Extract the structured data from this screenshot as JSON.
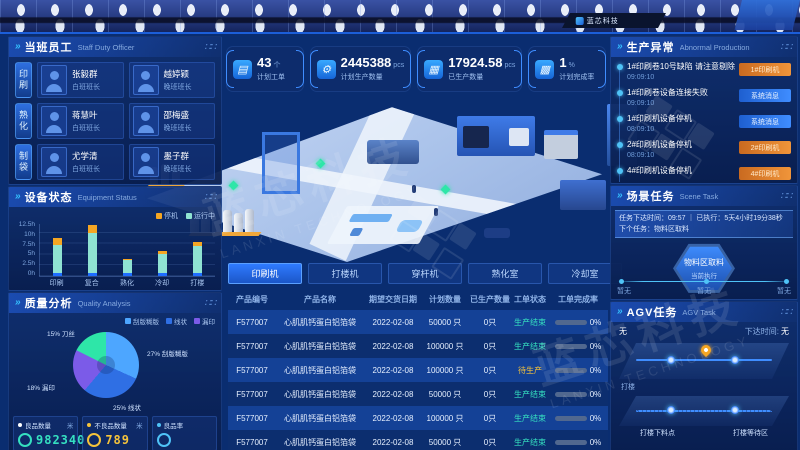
{
  "banner": {
    "logo_text": "蓝芯科技"
  },
  "watermark": {
    "zh": "蓝芯科技",
    "en": "LANXIN TECHNOLOGY"
  },
  "staff": {
    "title": "当班员工",
    "subtitle": "Staff Duty Officer",
    "groups": [
      {
        "tag": "印刷",
        "members": [
          {
            "name": "张毅群",
            "role": "白班班长"
          },
          {
            "name": "越婷颖",
            "role": "晚班班长"
          }
        ]
      },
      {
        "tag": "熟化",
        "members": [
          {
            "name": "蒋慧叶",
            "role": "白班班长"
          },
          {
            "name": "邵梅盛",
            "role": "晚班班长"
          }
        ]
      },
      {
        "tag": "制袋",
        "members": [
          {
            "name": "尤学清",
            "role": "白班班长"
          },
          {
            "name": "墨子群",
            "role": "晚班班长"
          }
        ]
      }
    ]
  },
  "kpis": [
    {
      "icon": "clipboard-icon",
      "value": "43",
      "unit": "个",
      "label": "计划工单"
    },
    {
      "icon": "gear-icon",
      "value": "2445388",
      "unit": "pcs",
      "label": "计划生产数量"
    },
    {
      "icon": "boxes-icon",
      "value": "17924.58",
      "unit": "pcs",
      "label": "已生产数量"
    },
    {
      "icon": "boxes-percent-icon",
      "value": "1",
      "unit": "%",
      "label": "计划完成率"
    }
  ],
  "equipment": {
    "title": "设备状态",
    "subtitle": "Equipment Status"
  },
  "quality": {
    "title": "质量分析",
    "subtitle": "Quality Analysis",
    "pie_labels": [
      "15% 刀丝",
      "27% 刮版糊版",
      "18% 漏印",
      "25% 线状"
    ],
    "stats": [
      {
        "label": "良品数量",
        "unit": "米",
        "value": "982340"
      },
      {
        "label": "不良品数量",
        "unit": "米",
        "value": "789"
      },
      {
        "label": "良品率",
        "unit": "",
        "value": ""
      }
    ]
  },
  "abnormal": {
    "title": "生产异常",
    "subtitle": "Abnormal Production",
    "items": [
      {
        "text": "1#印刷卷10号缺陷 请注意剔除",
        "time": "09:09:10",
        "tag": "1#印刷机",
        "tag_type": "orange"
      },
      {
        "text": "1#印刷卷设备连接失败",
        "time": "09:09:10",
        "tag": "系统消息",
        "tag_type": "blue"
      },
      {
        "text": "1#印刷机设备停机",
        "time": "08:09:10",
        "tag": "系统消息",
        "tag_type": "blue"
      },
      {
        "text": "2#印刷机设备停机",
        "time": "08:09:10",
        "tag": "2#印刷机",
        "tag_type": "orange"
      },
      {
        "text": "4#印刷机设备停机",
        "time": "",
        "tag": "4#印刷机",
        "tag_type": "orange"
      }
    ]
  },
  "scene_task": {
    "title": "场景任务",
    "subtitle": "Scene Task",
    "info": "任务下达时间：09:57 ｜ 已执行：5天4小时19分38秒　下个任务：物料区取料",
    "hex_title": "物料区取料",
    "hex_sub": "当前执行",
    "timeline": [
      "暂无",
      "暂无",
      "暂无"
    ]
  },
  "agv_task": {
    "title": "AGV任务",
    "subtitle": "AGV Task",
    "status": "无",
    "issue_time_label": "下达时间:",
    "issue_time": "无",
    "track_label": "打楼",
    "stations": [
      "打楼下料点",
      "打楼等待区"
    ]
  },
  "worksheet": {
    "tabs": [
      "印刷机",
      "打楼机",
      "穿杆机",
      "熟化室",
      "冷却室"
    ],
    "headers": [
      "产品编号",
      "产品名称",
      "期望交货日期",
      "计划数量",
      "已生产数量",
      "工单状态",
      "工单完成率"
    ],
    "rows": [
      [
        "F577007",
        "心肌肌钙蛋白铝箔袋",
        "2022-02-08",
        "50000 只",
        "0只",
        "生产结束",
        "0%"
      ],
      [
        "F577007",
        "心肌肌钙蛋白铝箔袋",
        "2022-02-08",
        "100000 只",
        "0只",
        "生产结束",
        "0%"
      ],
      [
        "F577007",
        "心肌肌钙蛋白铝箔袋",
        "2022-02-08",
        "100000 只",
        "0只",
        "待生产",
        "0%"
      ],
      [
        "F577007",
        "心肌肌钙蛋白铝箔袋",
        "2022-02-08",
        "50000 只",
        "0只",
        "生产结束",
        "0%"
      ],
      [
        "F577007",
        "心肌肌钙蛋白铝箔袋",
        "2022-02-08",
        "100000 只",
        "0只",
        "生产结束",
        "0%"
      ],
      [
        "F577007",
        "心肌肌钙蛋白铝箔袋",
        "2022-02-08",
        "50000 只",
        "0只",
        "生产结束",
        "0%"
      ]
    ]
  },
  "chart_data": [
    {
      "id": "equipment_status",
      "type": "bar",
      "stacked": true,
      "categories": [
        "印刷",
        "复合",
        "熟化",
        "冷却",
        "打楼"
      ],
      "series": [
        {
          "name": "待机",
          "color": "#1e6dff",
          "values": [
            0.8,
            0.8,
            0.8,
            0.8,
            0.8
          ]
        },
        {
          "name": "运行中",
          "color": "#8fe3d2",
          "values": [
            6.7,
            9.5,
            3.1,
            4.5,
            6.4
          ]
        },
        {
          "name": "停机",
          "color": "#f5a623",
          "values": [
            1.7,
            1.9,
            0.3,
            0.6,
            1.0
          ]
        }
      ],
      "ylim": [
        0,
        12.5
      ],
      "yticks": [
        "0h",
        "2.5h",
        "5h",
        "7.5h",
        "10h",
        "12.5h"
      ],
      "legend": [
        "停机",
        "运行中"
      ],
      "legend_position": "top-right",
      "grid": true
    },
    {
      "id": "quality_analysis",
      "type": "pie",
      "slices": [
        {
          "label": "刮版糊版",
          "pct": 27,
          "color": "#4da6ff"
        },
        {
          "label": "线状",
          "pct": 25,
          "color": "#2f6fe4"
        },
        {
          "label": "漏印",
          "pct": 18,
          "color": "#7b5be8"
        },
        {
          "label": "刀丝",
          "pct": 15,
          "color": "#2ee6a8"
        }
      ],
      "legend": [
        "刮版糊版",
        "线状",
        "漏印"
      ],
      "legend_position": "top-right"
    }
  ]
}
